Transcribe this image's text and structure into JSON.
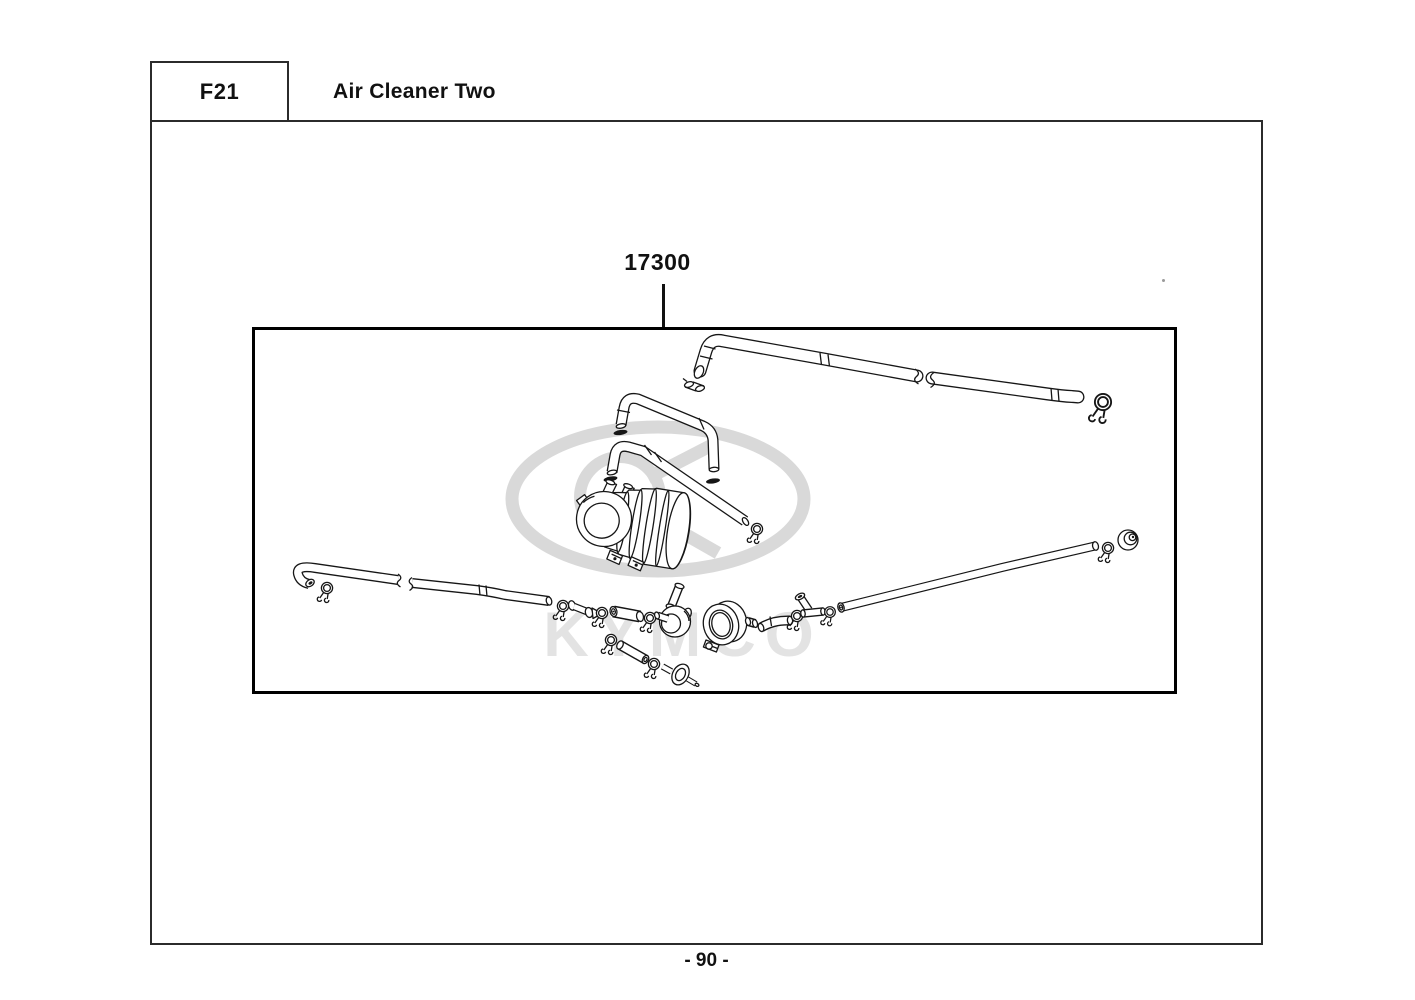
{
  "page": {
    "header": {
      "section_code": "F21",
      "section_title": "Air Cleaner Two"
    },
    "figure": {
      "part_number": "17300",
      "watermark_text": "KYMCO",
      "component_names": [
        "upper-breather-tube",
        "breather-tube-segment",
        "wire-hose-clip",
        "small-clamp-fitting",
        "arch-breather-hose",
        "elbow-drain-hose",
        "flange-gasket",
        "air-cleaner-case",
        "left-drain-tube",
        "hose-clamp",
        "joint-connector",
        "connector-sleeve",
        "one-way-valve",
        "band-clamp",
        "plug-cap",
        "connector-hose",
        "tee-joint",
        "right-drain-tube",
        "end-grommet",
        "drain-tube-segment",
        "inline-filter"
      ]
    },
    "footer": {
      "page_number": "- 90 -"
    }
  },
  "colors": {
    "background": "#ffffff",
    "line": "#161616",
    "page_border": "#2b2b2b",
    "figure_border": "#000000",
    "watermark_emblem": "#d9d9d9",
    "watermark_text": "#e3e3e3"
  }
}
